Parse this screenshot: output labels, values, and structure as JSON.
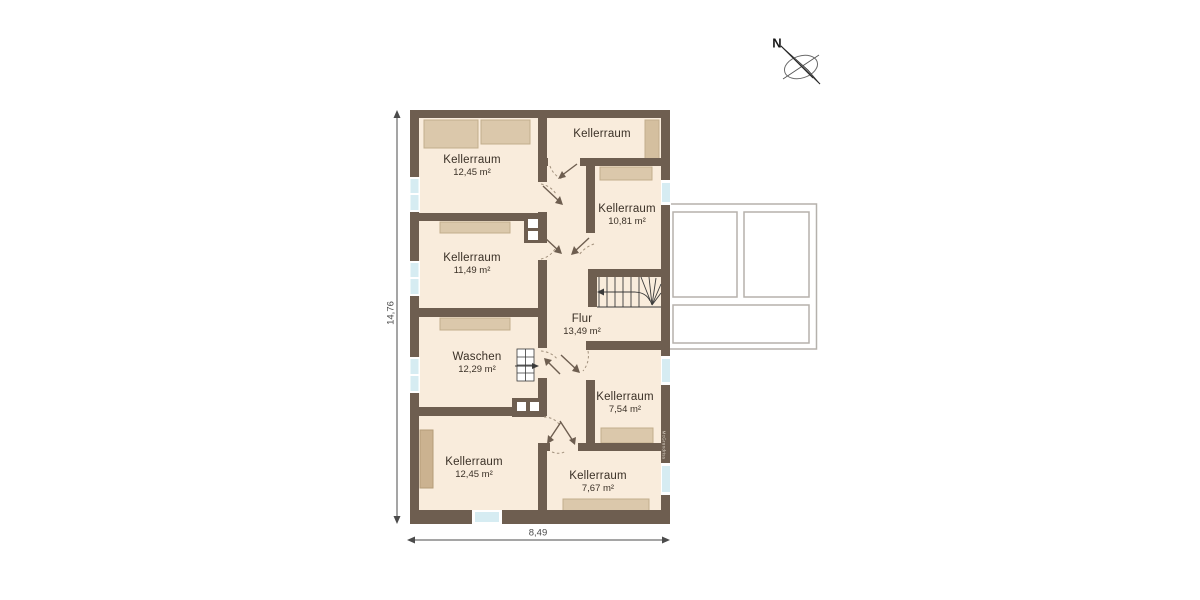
{
  "compass": {
    "north_label": "N"
  },
  "dimensions": {
    "vertical": "14,76",
    "horizontal": "8,49"
  },
  "watermark": "McGrundriss",
  "rooms": [
    {
      "name": "Kellerraum",
      "area": "12,45 m²"
    },
    {
      "name": "Kellerraum",
      "area": ""
    },
    {
      "name": "Kellerraum",
      "area": "10,81 m²"
    },
    {
      "name": "Kellerraum",
      "area": "11,49 m²"
    },
    {
      "name": "Flur",
      "area": "13,49 m²"
    },
    {
      "name": "Waschen",
      "area": "12,29 m²"
    },
    {
      "name": "Kellerraum",
      "area": "7,54 m²"
    },
    {
      "name": "Kellerraum",
      "area": "12,45 m²"
    },
    {
      "name": "Kellerraum",
      "area": "7,67 m²"
    }
  ],
  "colors": {
    "wall": "#6e5e50",
    "floor": "#f9ecdc",
    "furniture": "#dbc8ab",
    "window_glass": "#d6ecf2",
    "annex_outline": "#b5b1ac",
    "label_text": "#3a3026",
    "dimension_text": "#4b4b4b"
  }
}
